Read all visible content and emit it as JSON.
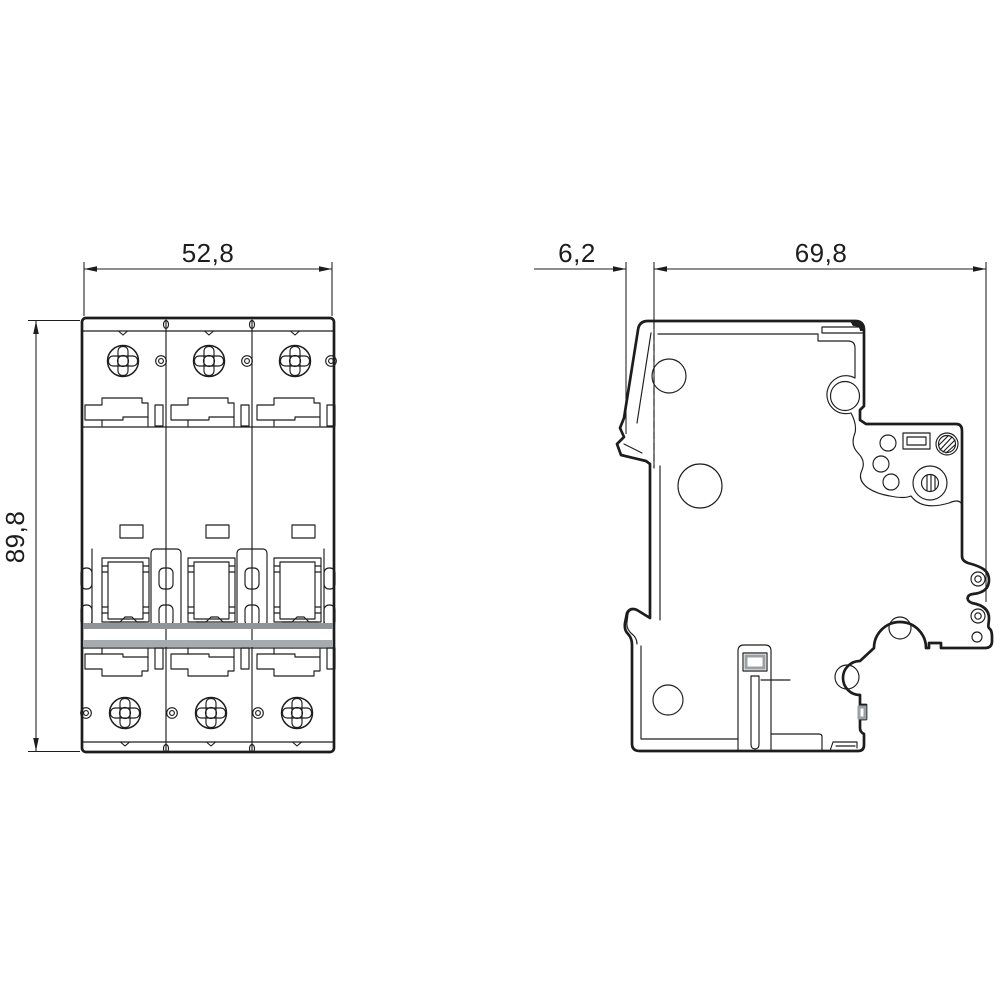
{
  "drawing": {
    "kind": "technical dimensional drawing, 3-pole miniature circuit breaker",
    "dimensions": {
      "front_width_mm": "52,8",
      "front_height_mm": "89,8",
      "side_handle_offset_mm": "6,2",
      "side_depth_mm": "69,8"
    },
    "colors": {
      "line": "#1d1d1d",
      "din_rail_gray": "#90959a",
      "background": "#ffffff"
    }
  }
}
